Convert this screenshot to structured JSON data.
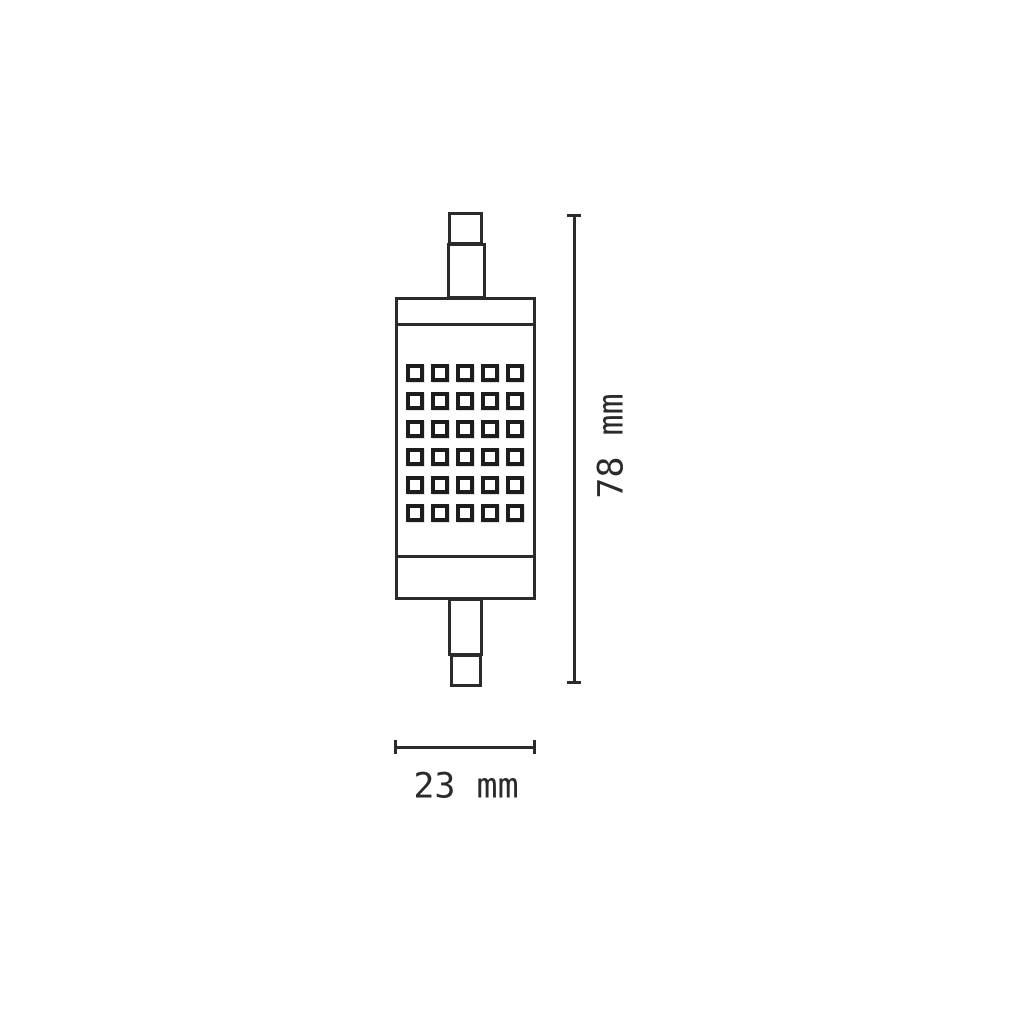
{
  "diagram": {
    "dimensions": {
      "height": {
        "label": "78 mm",
        "value": 78,
        "unit": "mm",
        "orientation": "vertical"
      },
      "width": {
        "label": "23 mm",
        "value": 23,
        "unit": "mm",
        "orientation": "horizontal"
      }
    },
    "led_grid": {
      "rows": 6,
      "columns": 5,
      "count": 30
    },
    "colors": {
      "stroke": "#2b2b2b",
      "led_border": "#1d1d1d",
      "background": "#ffffff"
    }
  }
}
